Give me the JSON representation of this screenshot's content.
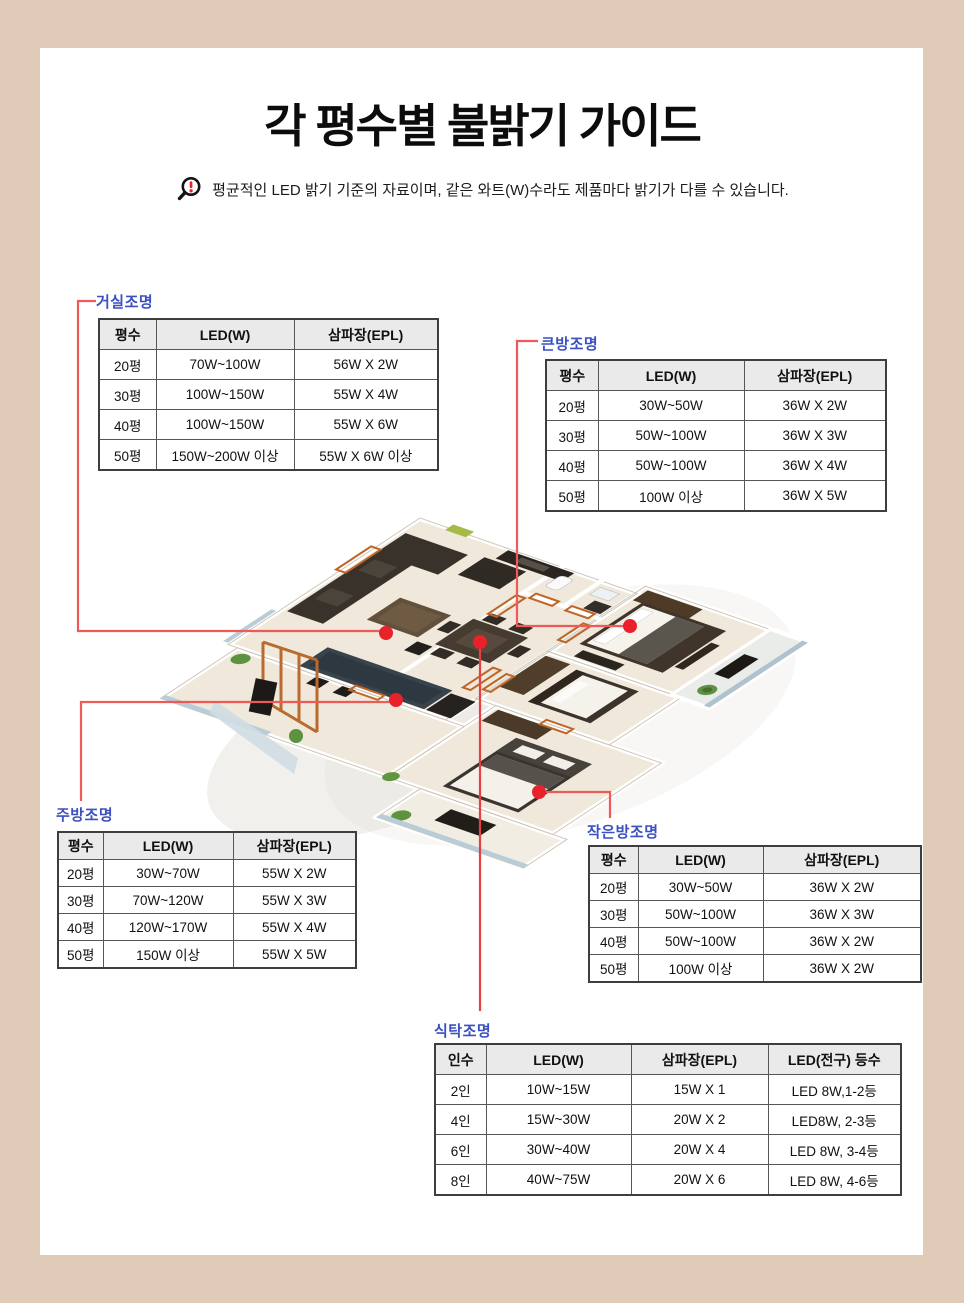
{
  "page": {
    "title": "각 평수별 불밝기 가이드",
    "notice": "평균적인 LED 밝기 기준의 자료이며, 같은 와트(W)수라도 제품마다 밝기가 다를 수 있습니다.",
    "notice_icon": "magnifier-alert-icon",
    "colors": {
      "background": "#dfcbb8",
      "panel": "#ffffff",
      "label_blue": "#3b50c1",
      "marker_red": "#e8212b",
      "connector_red": "#ee5a57",
      "table_header_bg": "#eaeaea",
      "table_border": "#3e3e3e"
    }
  },
  "tables": {
    "living": {
      "label": "거실조명",
      "headers": [
        "평수",
        "LED(W)",
        "삼파장(EPL)"
      ],
      "rows": [
        [
          "20평",
          "70W~100W",
          "56W X 2W"
        ],
        [
          "30평",
          "100W~150W",
          "55W X 4W"
        ],
        [
          "40평",
          "100W~150W",
          "55W X 6W"
        ],
        [
          "50평",
          "150W~200W 이상",
          "55W X 6W 이상"
        ]
      ]
    },
    "big_room": {
      "label": "큰방조명",
      "headers": [
        "평수",
        "LED(W)",
        "삼파장(EPL)"
      ],
      "rows": [
        [
          "20평",
          "30W~50W",
          "36W X 2W"
        ],
        [
          "30평",
          "50W~100W",
          "36W X 3W"
        ],
        [
          "40평",
          "50W~100W",
          "36W X 4W"
        ],
        [
          "50평",
          "100W 이상",
          "36W X 5W"
        ]
      ]
    },
    "kitchen": {
      "label": "주방조명",
      "headers": [
        "평수",
        "LED(W)",
        "삼파장(EPL)"
      ],
      "rows": [
        [
          "20평",
          "30W~70W",
          "55W X 2W"
        ],
        [
          "30평",
          "70W~120W",
          "55W X 3W"
        ],
        [
          "40평",
          "120W~170W",
          "55W X 4W"
        ],
        [
          "50평",
          "150W 이상",
          "55W X 5W"
        ]
      ]
    },
    "small_room": {
      "label": "작은방조명",
      "headers": [
        "평수",
        "LED(W)",
        "삼파장(EPL)"
      ],
      "rows": [
        [
          "20평",
          "30W~50W",
          "36W X 2W"
        ],
        [
          "30평",
          "50W~100W",
          "36W X 3W"
        ],
        [
          "40평",
          "50W~100W",
          "36W X 2W"
        ],
        [
          "50평",
          "100W 이상",
          "36W X 2W"
        ]
      ]
    },
    "dining": {
      "label": "식탁조명",
      "headers": [
        "인수",
        "LED(W)",
        "삼파장(EPL)",
        "LED(전구) 등수"
      ],
      "rows": [
        [
          "2인",
          "10W~15W",
          "15W X 1",
          "LED 8W,1-2등"
        ],
        [
          "4인",
          "15W~30W",
          "20W X 2",
          "LED8W, 2-3등"
        ],
        [
          "6인",
          "30W~40W",
          "20W X 4",
          "LED 8W, 3-4등"
        ],
        [
          "8인",
          "40W~75W",
          "20W X 6",
          "LED 8W, 4-6등"
        ]
      ]
    }
  },
  "floor_plan": {
    "type": "3d-isometric-apartment-render",
    "markers": [
      "living-room-marker",
      "big-room-marker",
      "kitchen-marker",
      "small-room-marker",
      "dining-marker"
    ]
  }
}
